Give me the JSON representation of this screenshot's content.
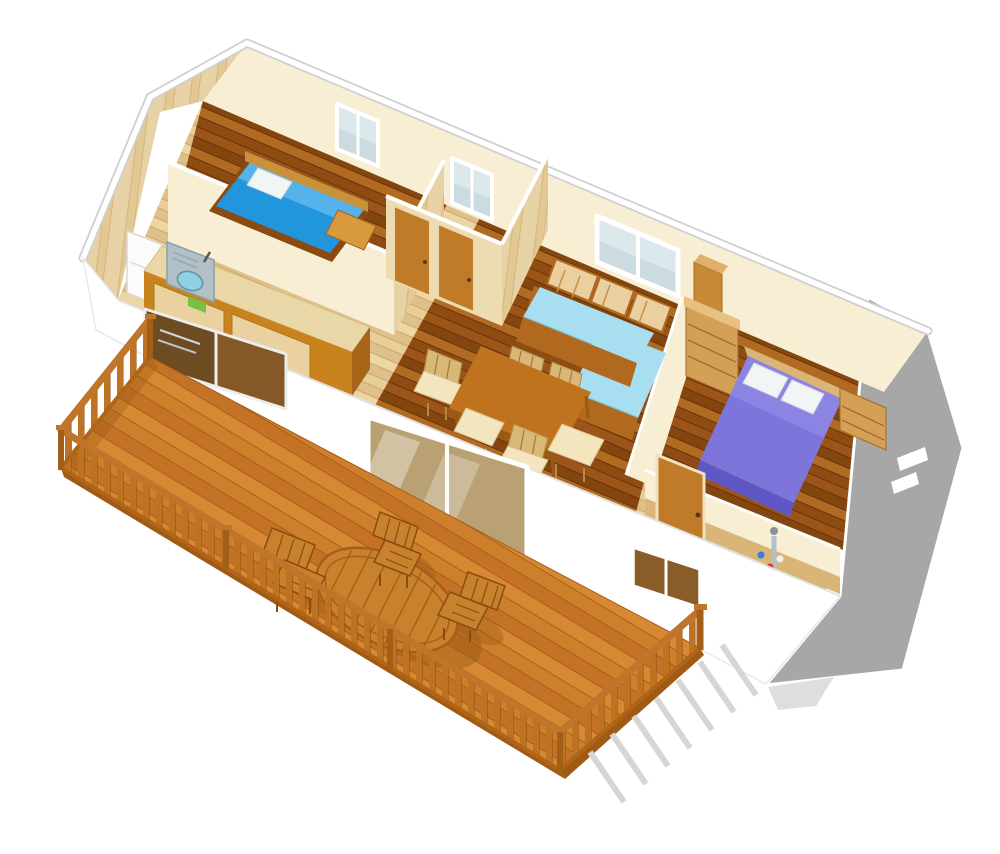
{
  "scene": {
    "description": "3D perspective cutaway rendering of a mobile-home floor plan with a large wooden deck terrace",
    "rooms": [
      "children-bedroom",
      "kitchen",
      "hallway-wc",
      "living-dining",
      "master-bedroom",
      "shower-room"
    ],
    "deck_items": [
      "wood-railing",
      "oval-slat-table",
      "deck-armchairs",
      "railing-shadow"
    ],
    "furniture_counts": {
      "dining_chairs": 6,
      "deck_chairs": 3,
      "beds": 2,
      "sofas": 1,
      "back_wall_windows": 3,
      "front_openings": 3,
      "end_wall_vents": 2
    }
  },
  "colors": {
    "bg": "#ffffff",
    "outline": "#cfcfcf",
    "wall_cream": "#f8eed4",
    "wall_cream_shade": "#eddcb2",
    "wood_panel": "#e7d2a6",
    "wood_panel_b": "#e2c892",
    "wood_grain": "#d4b67c",
    "floor_l1": "#e8cf9a",
    "floor_l2": "#dfc08a",
    "floor_l3": "#ecd6a6",
    "floor_lseam": "#c9a863",
    "floor_d1": "#9c5518",
    "floor_d2": "#84460f",
    "floor_d3": "#b06a22",
    "floor_d4": "#8f4c12",
    "floor_dseam": "#6b3008",
    "deck1": "#cd7f2b",
    "deck2": "#c47326",
    "deck3": "#d68932",
    "deck_seam": "#a65f19",
    "deck_edge": "#a05a14",
    "deck_shadow": "#9c5a14",
    "rail_top": "#c0762a",
    "rail_bal": "#bd7322",
    "rail_post": "#a35f17",
    "rail_bot": "#b06418",
    "deck_furn": "#c8812c",
    "deck_furn_dark": "#8a4c10",
    "table_top": "#bf731e",
    "table_edge": "#9a5a14",
    "chair_wood": "#d9b877",
    "chair_seat": "#f3e5bd",
    "counter_top": "#ead7a8",
    "cabinet": "#c8821e",
    "cabinet_panel": "#e9d2a0",
    "cabinet_side": "#a86418",
    "fridge": "#fbfbfb",
    "sink_steel": "#b2c0c8",
    "sink_basin": "#8fd0e4",
    "board_green": "#76c043",
    "bed_blue": "#2196dc",
    "bed_blue_hi": "#64b9ee",
    "pillow": "#f2f5f6",
    "headboard": "#c8923c",
    "sofa_seat": "#a8dff0",
    "sofa_edge": "#7cc8e0",
    "sofa_wood": "#b0691f",
    "slat_panel": "#ead0a0",
    "door_wood": "#c07b28",
    "bed_purple": "#7d75da",
    "bed_purple_hi": "#928ae6",
    "bed_purple_dk": "#5f58c4",
    "hb_light": "#d9b678",
    "dresser": "#d3a055",
    "dresser_line": "#9a6428",
    "wardrobe": "#c98a35",
    "glass": "#dce9ec",
    "glass_sheen": "#c3d4da",
    "glass_brown": "#8a5c28",
    "glass_door": "#b9a173",
    "glass_kitchen": "#6e4c22",
    "frame": "#ffffff",
    "gray_wall": "#a7a7a7",
    "shadow": "#d6d6d6",
    "shadow_soft": "#dedede"
  }
}
